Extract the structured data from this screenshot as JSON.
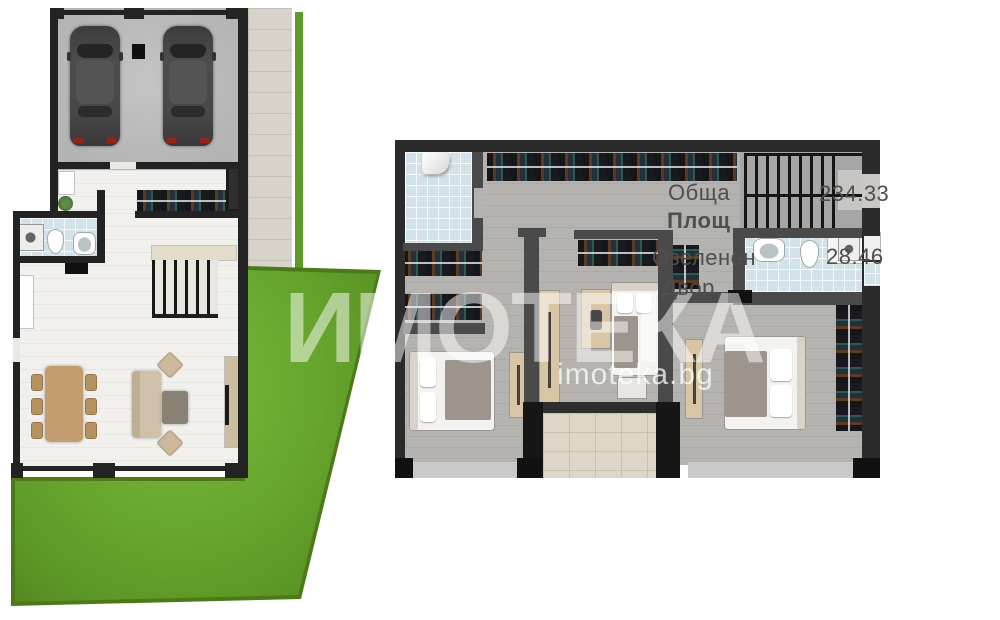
{
  "watermark": {
    "brand": "ИМОТЕКА",
    "site": "imoteka.bg"
  },
  "area_labels": {
    "total": {
      "line1": "Обща",
      "line2": "Площ",
      "value": "234.33"
    },
    "yard": {
      "line1": "Озеленен",
      "line2": "Двор",
      "value": "28.46"
    }
  },
  "colors": {
    "wall": "#232323",
    "wall_gray": "#4a4a4a",
    "floor_light": "#f1f0ed",
    "floor_gray": "#b5b3b0",
    "tile_blue": "#d3e1e8",
    "pavement": "#d7d3ca",
    "terrace": "#ded6c6",
    "grass": "#68a72f",
    "grass_dark": "#4c7a18",
    "label": "#4f4f4f",
    "accent_red": "#93231c"
  }
}
